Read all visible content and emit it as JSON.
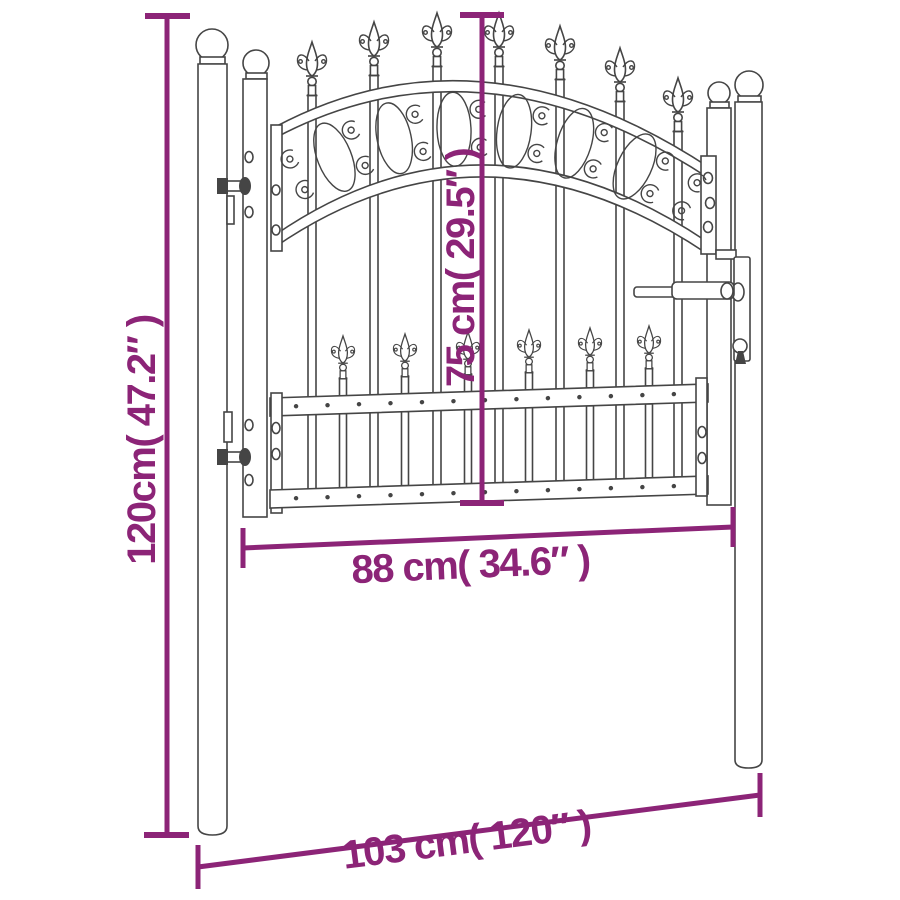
{
  "diagram": {
    "background": "#ffffff",
    "drawing_color": "#454545",
    "accent_color": "#8c2477",
    "dimensions": {
      "overall_height": {
        "label": "120cm( 47.2″ )",
        "cm": "120",
        "inches": "47.2″"
      },
      "gate_height": {
        "label": "75 cm( 29.5″ )",
        "cm": "75",
        "inches": "29.5″"
      },
      "gate_width": {
        "label": "88 cm( 34.6″ )",
        "cm": "88",
        "inches": "34.6″"
      },
      "overall_width": {
        "label": "103 cm( 120″ )",
        "cm": "103",
        "inches": "120″"
      }
    }
  }
}
